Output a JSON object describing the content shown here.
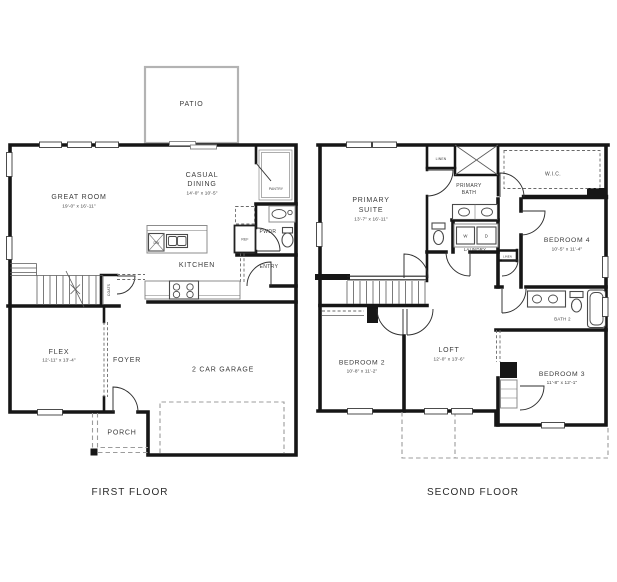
{
  "colors": {
    "wall": "#161616",
    "thin_line": "#5a5a5a",
    "dashed_line": "#9c9c9c",
    "patio_outline": "#b3b3b3",
    "text": "#3b3b3b",
    "background": "#ffffff"
  },
  "floors": {
    "first": {
      "label": "FIRST FLOOR",
      "rooms": {
        "patio": {
          "name": "PATIO"
        },
        "great_room": {
          "name": "GREAT ROOM",
          "dims": "19'-0\" x 16'-11\""
        },
        "casual_dining": {
          "line1": "CASUAL",
          "line2": "DINING",
          "dims": "14'-0\" x 10'-5\""
        },
        "pantry": {
          "name": "PANTRY"
        },
        "pwdr": {
          "name": "PWDR"
        },
        "kitchen": {
          "name": "KITCHEN"
        },
        "entry": {
          "name": "ENTRY"
        },
        "ref": {
          "name": "REF"
        },
        "dw": {
          "name": "DW"
        },
        "coats": {
          "name": "COATS"
        },
        "flex": {
          "name": "FLEX",
          "dims": "12'-11\" x 13'-4\""
        },
        "foyer": {
          "name": "FOYER"
        },
        "garage": {
          "name": "2 CAR GARAGE"
        },
        "porch": {
          "name": "PORCH"
        }
      }
    },
    "second": {
      "label": "SECOND FLOOR",
      "rooms": {
        "primary_suite": {
          "line1": "PRIMARY",
          "line2": "SUITE",
          "dims": "13'-7\" x 16'-11\""
        },
        "linen_upper": {
          "name": "LINEN"
        },
        "primary_bath": {
          "line1": "PRIMARY",
          "line2": "BATH"
        },
        "wic": {
          "name": "W.I.C."
        },
        "laundry": {
          "name": "LAUNDRY"
        },
        "washer": {
          "name": "W"
        },
        "dryer": {
          "name": "D"
        },
        "linen_hall": {
          "name": "LINEN"
        },
        "bedroom4": {
          "name": "BEDROOM 4",
          "dims": "10'-5\" x 11'-4\""
        },
        "bath2": {
          "name": "BATH 2"
        },
        "bedroom2": {
          "name": "BEDROOM 2",
          "dims": "10'-8\" x 11'-2\""
        },
        "loft": {
          "name": "LOFT",
          "dims": "12'-0\" x 13'-6\""
        },
        "bedroom3": {
          "name": "BEDROOM 3",
          "dims": "11'-8\" x 12'-1\""
        }
      }
    }
  }
}
